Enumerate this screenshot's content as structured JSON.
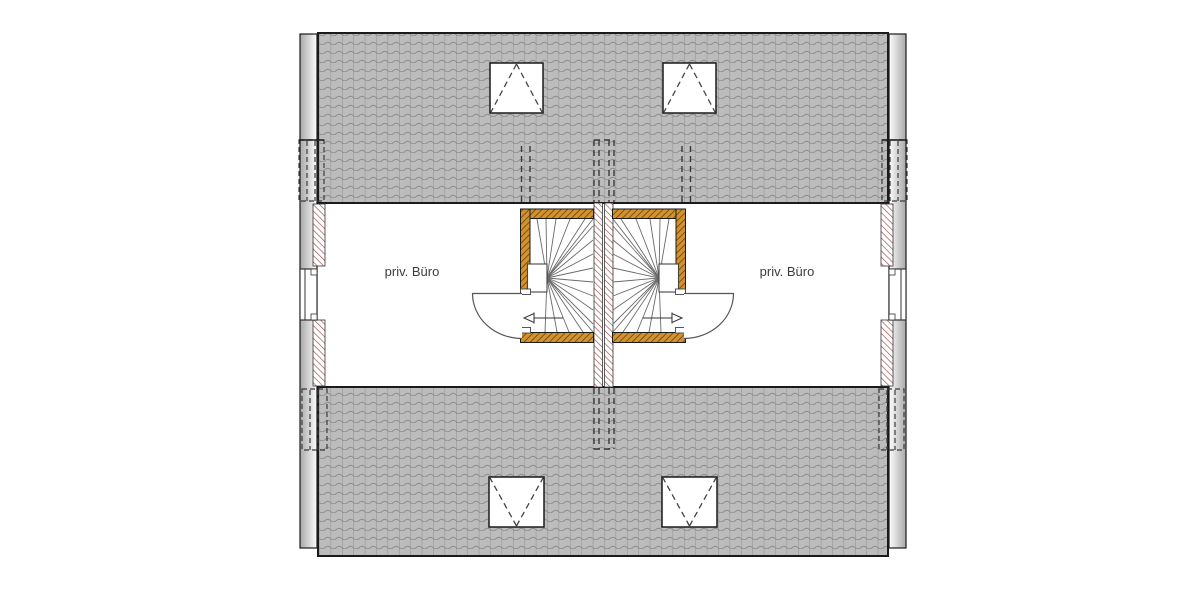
{
  "plan": {
    "title": "attic floor plan (duplex)",
    "room_labels": {
      "left": "priv. Büro",
      "right": "priv. Büro"
    },
    "colors": {
      "roof_fill": "#bcbcbc",
      "roof_line": "#8f8f8f",
      "outline": "#1a1a1a",
      "timber_fill": "#d3922e",
      "timber_hatch": "#54380c",
      "masonry_hatch": "#9c4a4a",
      "hidden_line": "#3a3a3a",
      "stair_line": "#6a6a6a",
      "label_text": "#3c3c3c"
    },
    "symbols": {
      "skylight_count": 4,
      "stair_direction_left": "left",
      "stair_direction_right": "right"
    }
  }
}
